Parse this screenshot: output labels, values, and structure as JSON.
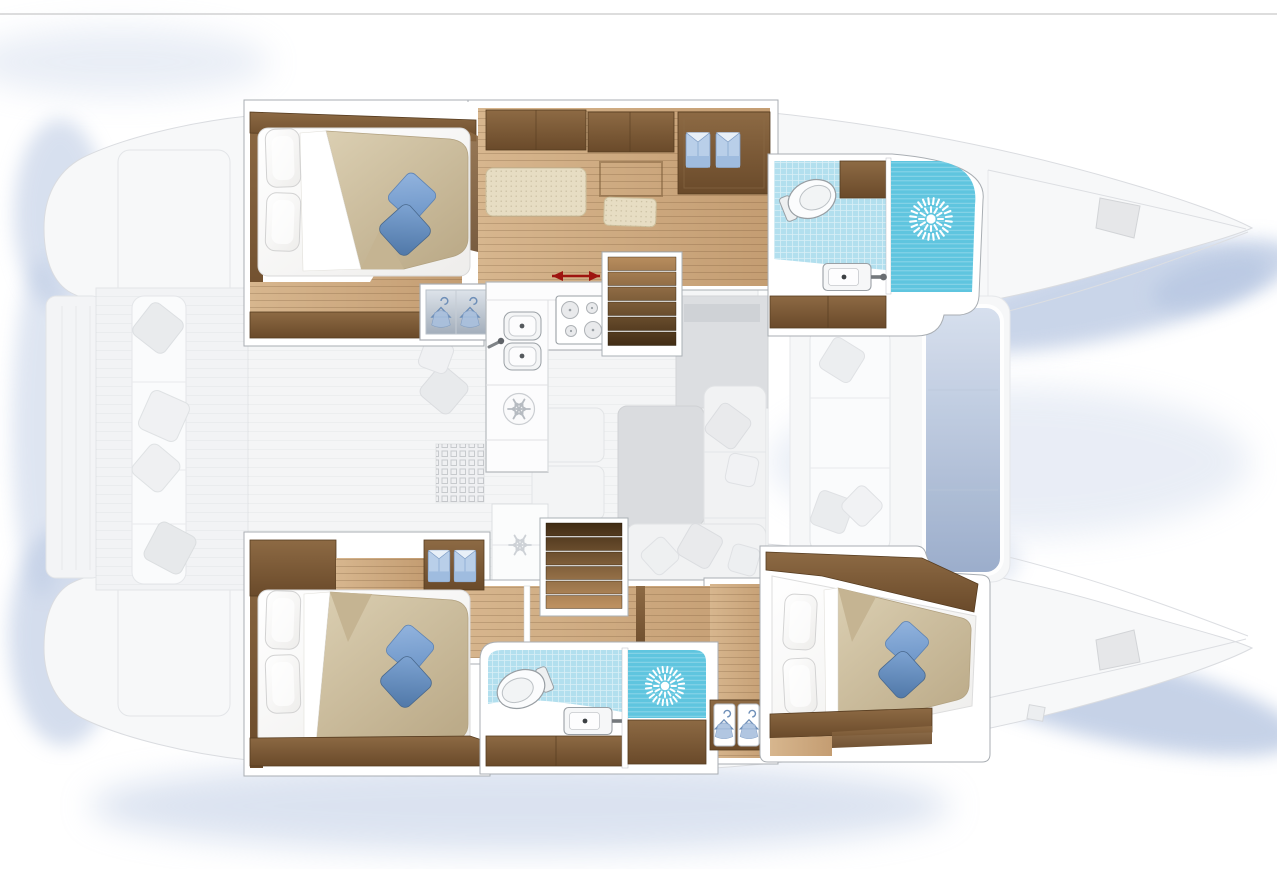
{
  "page": {
    "width": 1277,
    "height": 869,
    "background": "#ffffff",
    "top_divider_color": "#dddddd"
  },
  "colors": {
    "background": "#ffffff",
    "divider": "#dddddd",
    "shadow_blue": "#b8c7e2",
    "hull_fill": "#f7f8f9",
    "hull_line": "#dadce0",
    "ghost_fill": "#f2f3f5",
    "ghost_line": "#e3e5e8",
    "frame_white": "#ffffff",
    "frame_line": "#a9aeb3",
    "wood": "#7c5b39",
    "wood_edge": "#563c20",
    "floor_wood": "#cfa97c",
    "cushion_beige": "#e7ddc3",
    "duvet_beige": "#cdbc9c",
    "pillow_blue": "#7fa6d6",
    "pillow_blue_dark": "#5d86bb",
    "tile_blue": "#b2dfee",
    "shower_blue": "#5fc5df",
    "fixture_line": "#9aa0a5",
    "stair_light": "#bc9060",
    "stair_dark": "#3c2811",
    "arrow_red": "#9e1410",
    "shirt_blue": "#b9cfe9",
    "pad_blue": "#aabdd9"
  },
  "legend_icons": {
    "shower": "starburst-spray-icon",
    "refrigerator": "snowflake-icon",
    "hanging_locker": "clothes-hanger-icon",
    "wardrobe": "folded-shirts-icon",
    "sliding_door": "red-double-arrow-icon"
  },
  "features": {
    "double_berths": 3,
    "bathrooms": 2,
    "separate_showers": 2,
    "galley_burners": 4,
    "galley_sinks": 2,
    "bathroom_sinks": 2,
    "companionway_stairs": 2
  }
}
